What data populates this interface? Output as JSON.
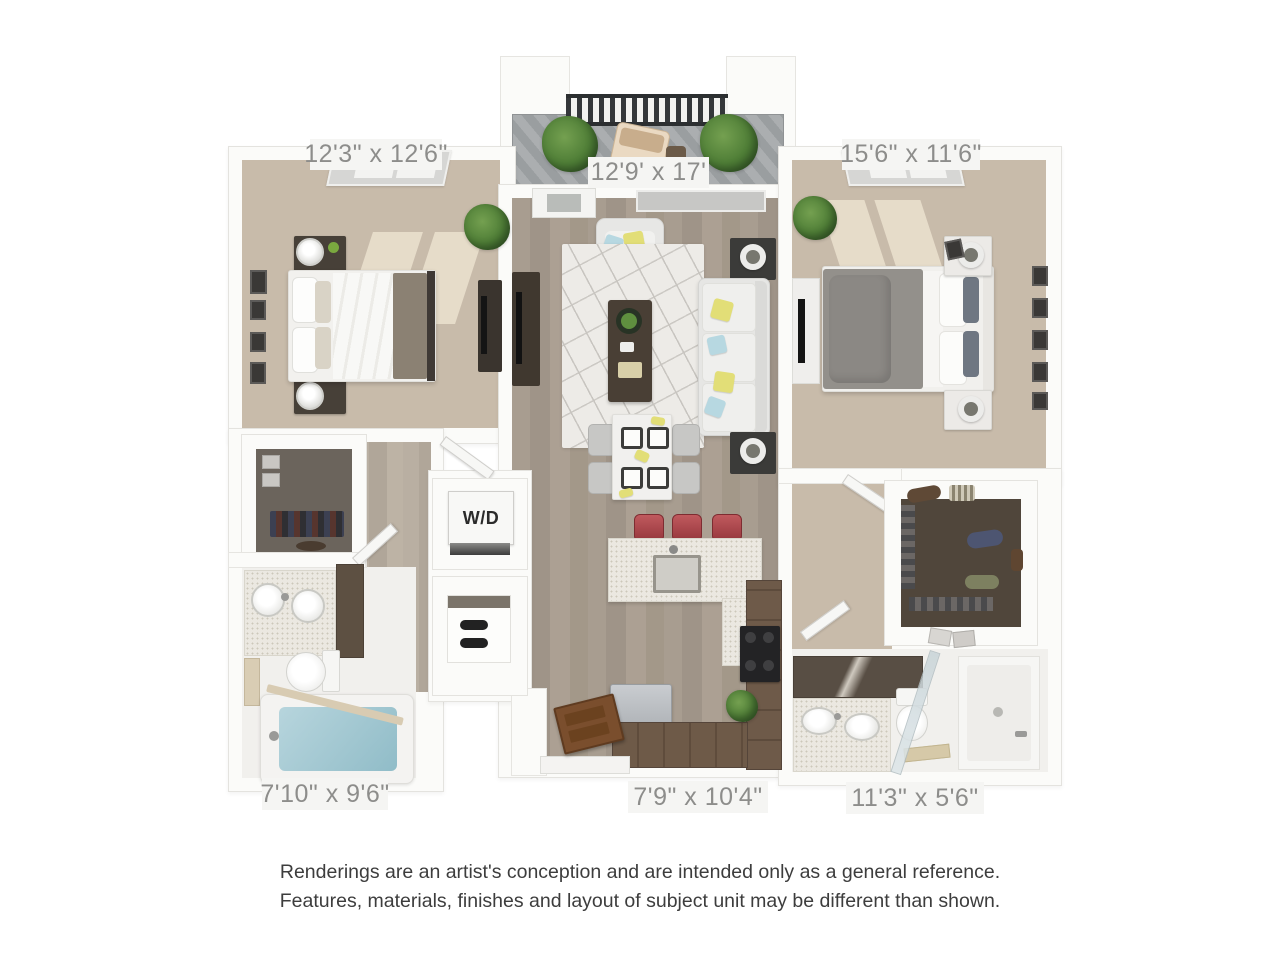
{
  "floorplan": {
    "rooms": [
      {
        "name": "bedroom-left",
        "dimensions": "12'3\" x 12'6\""
      },
      {
        "name": "living-room",
        "dimensions": "12'9' x 17'"
      },
      {
        "name": "bedroom-right",
        "dimensions": "15'6\" x 11'6\""
      },
      {
        "name": "bathroom-left",
        "dimensions": "7'10\" x 9'6\""
      },
      {
        "name": "kitchen",
        "dimensions": "7'9\" x 10'4\""
      },
      {
        "name": "bathroom-right",
        "dimensions": "11'3\" x 5'6\""
      }
    ],
    "washer_dryer_label": "W/D",
    "colors": {
      "carpet": "#c8bbaa",
      "wood_floor": "#a89d90",
      "label_text": "#8d8d8b",
      "stool_red": "#a64449",
      "pillow_yellow": "#e2de77",
      "pillow_blue": "#b7d8e1",
      "tub_water": "#a9ccd5",
      "cabinet_wood": "#6e5a49"
    }
  },
  "disclaimer": {
    "line1": "Renderings are an artist's conception and are intended only as a general reference.",
    "line2": "Features, materials, finishes and layout of subject unit may be different than shown."
  }
}
